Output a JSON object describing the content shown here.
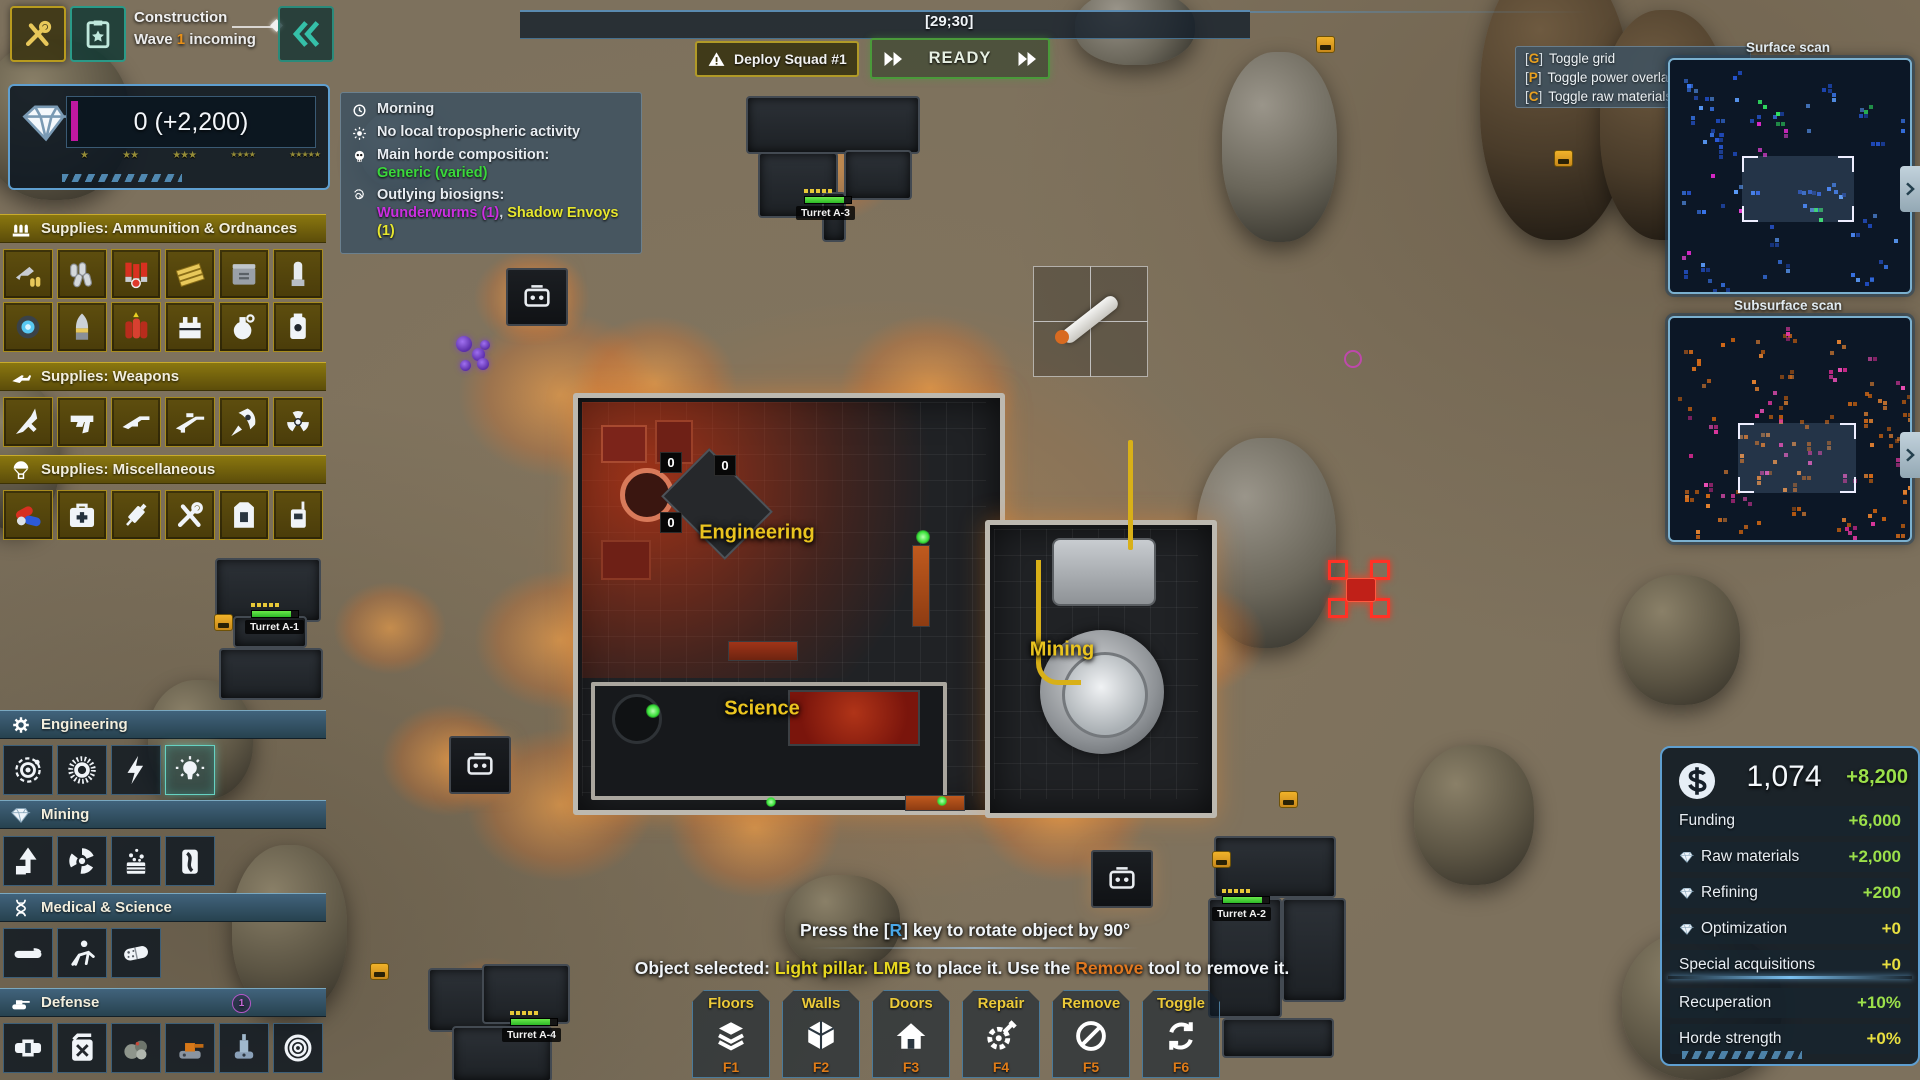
{
  "top_left": {
    "mode_label": "Construction",
    "wave_parts": [
      {
        "t": "Wave ",
        "c": "#ececec"
      },
      {
        "t": "1",
        "c": "#e89018"
      },
      {
        "t": " incoming",
        "c": "#ececec"
      }
    ]
  },
  "resources": {
    "value": "0 (+2,200)",
    "star_groups": [
      1,
      2,
      3,
      4,
      5
    ]
  },
  "conditions": {
    "rows": [
      {
        "icon": "clock-icon",
        "parts": [
          {
            "t": "Morning",
            "c": "#e8edf2"
          }
        ]
      },
      {
        "icon": "sun-icon",
        "parts": [
          {
            "t": "No local tropospheric activity",
            "c": "#e8edf2"
          }
        ]
      },
      {
        "icon": "skull-icon",
        "parts": [
          {
            "t": "Main horde composition:",
            "c": "#e8edf2"
          }
        ],
        "sub": [
          {
            "t": "Generic (varied)",
            "c": "#3ad83a"
          }
        ]
      },
      {
        "icon": "spiral-icon",
        "parts": [
          {
            "t": "Outlying biosigns:",
            "c": "#e8edf2"
          }
        ],
        "sub": [
          {
            "t": "Wunderwurms (1)",
            "c": "#cc2ee0"
          },
          {
            "t": ", ",
            "c": "#d0d8e0"
          },
          {
            "t": "Shadow Envoys (1)",
            "c": "#e6e62e"
          }
        ]
      }
    ]
  },
  "top_bar": {
    "coordinates": "[29;30]"
  },
  "squad": {
    "deploy_label": "Deploy Squad #1",
    "ready_label": "READY"
  },
  "overlay_hints": [
    {
      "key": "G",
      "label": "Toggle grid"
    },
    {
      "key": "P",
      "label": "Toggle power overlay"
    },
    {
      "key": "C",
      "label": "Toggle raw materials overlay"
    }
  ],
  "minimaps": {
    "surface_title": "Surface scan",
    "subsurface_title": "Subsurface scan"
  },
  "economy": {
    "total": "1,074",
    "delta": "+8,200",
    "rows": [
      {
        "icon": "",
        "label": "Funding",
        "value": "+6,000",
        "tone": "green"
      },
      {
        "icon": "diamond-icon",
        "label": "Raw materials",
        "value": "+2,000",
        "tone": "green"
      },
      {
        "icon": "diamond-icon",
        "label": "Refining",
        "value": "+200",
        "tone": "green"
      },
      {
        "icon": "diamond-icon",
        "label": "Optimization",
        "value": "+0",
        "tone": "yellow"
      },
      {
        "icon": "",
        "label": "Special acquisitions",
        "value": "+0",
        "tone": "yellow"
      }
    ],
    "rows_secondary": [
      {
        "label": "Recuperation",
        "value": "+10%",
        "tone": "green"
      },
      {
        "label": "Horde strength",
        "value": "+0%",
        "tone": "yellow"
      }
    ]
  },
  "messages": {
    "rotate_parts": [
      {
        "t": "Press the [",
        "c": "#f0f4f8"
      },
      {
        "t": "R",
        "c": "#4aa8e8"
      },
      {
        "t": "] key to rotate object by 90°",
        "c": "#f0f4f8"
      }
    ],
    "selected_parts": [
      {
        "t": "Object selected: ",
        "c": "#f0f4f8"
      },
      {
        "t": "Light pillar.",
        "c": "#e8d820"
      },
      {
        "t": " ",
        "c": "#f0f4f8"
      },
      {
        "t": "LMB",
        "c": "#e8d820"
      },
      {
        "t": " to place it. Use the ",
        "c": "#f0f4f8"
      },
      {
        "t": "Remove",
        "c": "#e07820"
      },
      {
        "t": " tool to remove it.",
        "c": "#f0f4f8"
      }
    ]
  },
  "toolbar": {
    "items": [
      {
        "label": "Floors",
        "key": "F1",
        "icon": "layers-icon"
      },
      {
        "label": "Walls",
        "key": "F2",
        "icon": "cube-icon"
      },
      {
        "label": "Doors",
        "key": "F3",
        "icon": "house-icon"
      },
      {
        "label": "Repair",
        "key": "F4",
        "icon": "gear-wrench-icon"
      },
      {
        "label": "Remove",
        "key": "F5",
        "icon": "no-entry-icon"
      },
      {
        "label": "Toggle",
        "key": "F6",
        "icon": "refresh-icon"
      }
    ]
  },
  "sidebar": {
    "sections": [
      {
        "id": "ammo",
        "title": "Supplies: Ammunition & Ordnances",
        "style": "gold",
        "icon": "shells-icon",
        "items": [
          "pistol-ammo-icon",
          "rifle-casings-icon",
          "shotgun-shells-icon",
          "ammo-belt-icon",
          "ammo-can-icon",
          "mortar-shell-icon",
          "energy-cell-icon",
          "artillery-shell-icon",
          "explosive-charge-icon",
          "detonator-icon",
          "grenade-icon",
          "mine-icon"
        ]
      },
      {
        "id": "weapons",
        "title": "Supplies: Weapons",
        "style": "gold",
        "icon": "rifle-icon",
        "items": [
          "knife-icon",
          "pistol-icon",
          "shotgun-icon",
          "sniper-rifle-icon",
          "missile-icon",
          "radiation-icon"
        ]
      },
      {
        "id": "misc",
        "title": "Supplies: Miscellaneous",
        "style": "gold",
        "icon": "parachute-icon",
        "items": [
          "pills-icon",
          "medkit-icon",
          "syringe-icon",
          "tools-icon",
          "armor-vest-icon",
          "radio-icon"
        ]
      },
      {
        "id": "engineering",
        "title": "Engineering",
        "style": "blue",
        "icon": "gear-icon",
        "items": [
          "orbit-generator-icon",
          "solar-generator-icon",
          "power-icon",
          "light-pillar-icon"
        ],
        "selected": 3
      },
      {
        "id": "mining",
        "title": "Mining",
        "style": "blue",
        "icon": "diamond-icon",
        "items": [
          "drill-tower-icon",
          "bore-icon",
          "chem-extractor-icon",
          "canister-icon"
        ]
      },
      {
        "id": "medical",
        "title": "Medical & Science",
        "style": "blue",
        "icon": "dna-icon",
        "items": [
          "stretcher-icon",
          "rescue-icon",
          "capsule-icon"
        ]
      },
      {
        "id": "defense",
        "title": "Defense",
        "style": "blue",
        "icon": "tank-icon",
        "badge": "1",
        "items": [
          "barrier-icon",
          "fuel-can-icon",
          "rubble-icon",
          "turret-orange-icon",
          "turret-blue-icon",
          "radar-icon"
        ]
      }
    ]
  },
  "map": {
    "rooms": [
      {
        "name": "Engineering"
      },
      {
        "name": "Science"
      },
      {
        "name": "Mining"
      }
    ],
    "turrets": [
      {
        "name": "Turret A-1"
      },
      {
        "name": "Turret A-2"
      },
      {
        "name": "Turret A-3"
      },
      {
        "name": "Turret A-4"
      }
    ],
    "counters": [
      "0",
      "0",
      "0"
    ]
  }
}
